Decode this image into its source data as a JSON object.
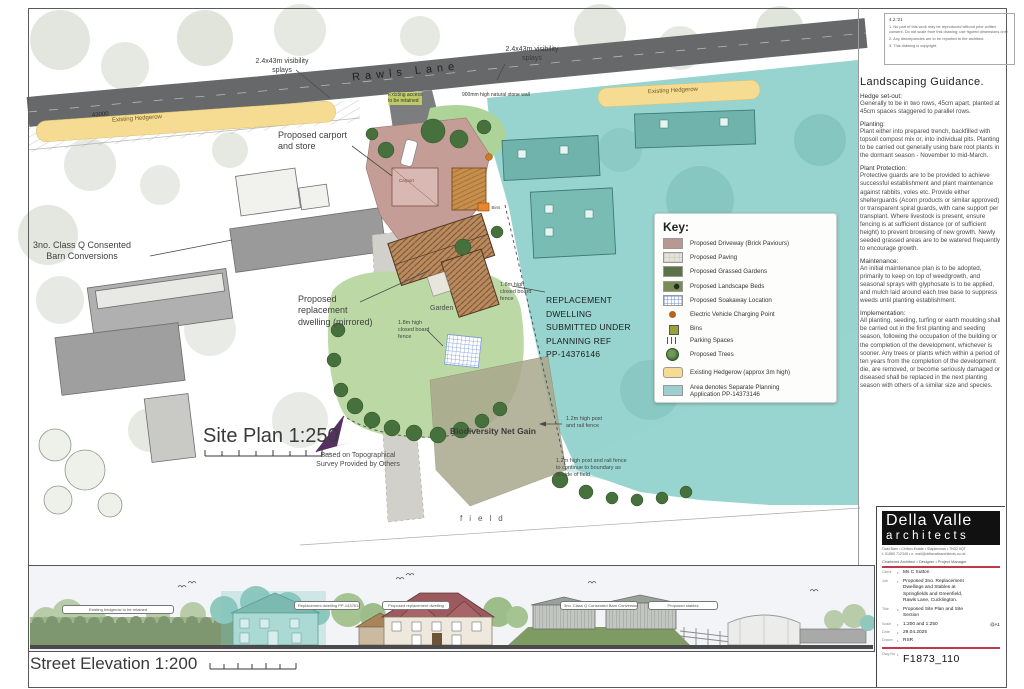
{
  "colors": {
    "teal_area": "#8fd0cb",
    "hedgerow_yellow": "#f6dc92",
    "driveway_pink": "#c59d97",
    "title_red": "#c0394b",
    "north_purple": "#563063"
  },
  "plan": {
    "road_name": "Rawls Lane",
    "dim_43000": "43000",
    "visibility_splay_left": "2.4x43m visibility\nsplays",
    "visibility_splay_right": "2.4x43m visibility\nsplays",
    "existing_hedgerow_left": "Existing Hedgerow",
    "existing_hedgerow_right": "Existing Hedgerow",
    "existing_access": "Existing access\nto be retained",
    "stone_wall": "900mm high natural stone wall",
    "carport": "Proposed carport\nand store",
    "carport_tiny": "Carport",
    "bins_tiny": "Bins",
    "barn_conversions": "3no. Class Q Consented\nBarn Conversions",
    "replacement_dwelling": "Proposed\nreplacement\ndwelling (mirrored)",
    "garden": "Garden",
    "closed_board_fence_1": "1.8m high\nclosed board\nfence",
    "closed_board_fence_2": "1.8m high\nclosed board\nfence",
    "planning_note": "REPLACEMENT\nDWELLING\nSUBMITTED UNDER\nPLANNING REF\nPP-14376146",
    "biodiversity": "Biodiversity Net Gain",
    "post_rail_fence": "1.2m high post\nand rail fence",
    "post_rail_fence_continue": "1.2m high post and rail fence\nto continue to boundary as\nto side of field",
    "field": "field",
    "site_plan_title": "Site Plan 1:250",
    "north_label": "north",
    "survey_note": "Based on Topographical\nSurvey Provided by Others"
  },
  "key": {
    "title": "Key:",
    "items": [
      {
        "label": "Proposed Driveway (Brick Paviours)",
        "swatch": "driveway"
      },
      {
        "label": "Proposed Paving",
        "swatch": "paving"
      },
      {
        "label": "Proposed Grassed Gardens",
        "swatch": "grass"
      },
      {
        "label": "Proposed Landscape Beds",
        "swatch": "beds"
      },
      {
        "label": "Proposed Soakaway Location",
        "swatch": "soakaway"
      },
      {
        "label": "Electric Vehicle Charging Point",
        "swatch": "ev"
      },
      {
        "label": "Bins",
        "swatch": "bins"
      },
      {
        "label": "Parking Spaces",
        "swatch": "parking"
      },
      {
        "label": "Proposed Trees",
        "swatch": "tree"
      },
      {
        "label": "Existing Hedgerow (approx 3m high)",
        "swatch": "hedge"
      },
      {
        "label": "Area denotes Separate Planning\nApplication PP-14373146",
        "swatch": "separate"
      }
    ]
  },
  "notes": {
    "header": "4.2.'21",
    "lines": [
      "1. No part of this work may be reproduced without prior written consent. Do not scale from this drawing; use figured dimensions only.",
      "2. Any discrepancies are to be reported to the architect.",
      "3. This drawing is copyright."
    ]
  },
  "guidance": {
    "heading": "Landscaping Guidance.",
    "sections": [
      {
        "title": "Hedge set-out:",
        "body": "Generally to be in two rows, 45cm apart, planted at 45cm spaces staggered to parallel rows."
      },
      {
        "title": "Planting:",
        "body": "Plant either into prepared trench, backfilled with topsoil compost mix or, into individual pits. Planting to be carried out generally using bare root plants in the dormant season - November to mid-March."
      },
      {
        "title": "Plant Protection:",
        "body": "Protective guards are to be provided to achieve successful establishment and plant maintenance against rabbits, voles etc. Provide either shelterguards (Acorn products or similar approved) or transparent spiral guards, with cane support per transplant. Where livestock is present, ensure fencing is at sufficient distance (or of sufficient height) to prevent browsing of new growth. Newly seeded grassed areas are to be watered frequently to encourage growth."
      },
      {
        "title": "Maintenance:",
        "body": "An initial maintenance plan is to be adopted, primarily to keep on top of weedgrowth, and seasonal sprays with glyphosate is to be applied, and mulch laid around each tree base to suppress weeds until planting establishment."
      },
      {
        "title": "Implementation:",
        "body": "All planting, seeding, turfing or earth moulding shall be carried out in the first planting and seeding season, following the occupation of the building or the completion of the development, whichever is sooner. Any trees or plants which within a period of ten years from the completion of the development die, are removed, or become seriously damaged or diseased shall be replaced in the next planting season with others of a similar size and species."
      }
    ]
  },
  "title_block": {
    "firm_line1": "Della Valle",
    "firm_line2": "architects",
    "address": "Oast Barn  •  Chilton Estate  •  Staplecross  •  TN32 5QT",
    "contact": "t. 01580 712345    •    e. mail@dellavallearchitects.co.uk",
    "roles": "Chartered Architect  •  Designer  •  Project Manager",
    "fields": [
      {
        "label": "Client",
        "value": "Ms C Sutton"
      },
      {
        "label": "Job",
        "value": "Proposed 3no. Replacement\nDwellings and Stables at\nSpringfields and Greenfield,\nRawls Lane, Cucklington."
      },
      {
        "label": "Title",
        "value": "Proposed Site Plan and Site\nSection"
      },
      {
        "label": "Scale",
        "value": "1:200 and 1:250",
        "suffix": "@A1"
      },
      {
        "label": "Date",
        "value": "29.04.2025"
      },
      {
        "label": "Drawn",
        "value": "RSR"
      }
    ],
    "dwg_label": "Dwg No",
    "dwg_no": "F1873_110"
  },
  "elevation": {
    "title": "Street Elevation 1:200",
    "labels": [
      "Existing hedgerow to be retained",
      "Replacement dwelling PP-14376146",
      "Proposed replacement dwelling",
      "3no. Class Q Consented Barn Conversions",
      "Proposed stables"
    ]
  }
}
